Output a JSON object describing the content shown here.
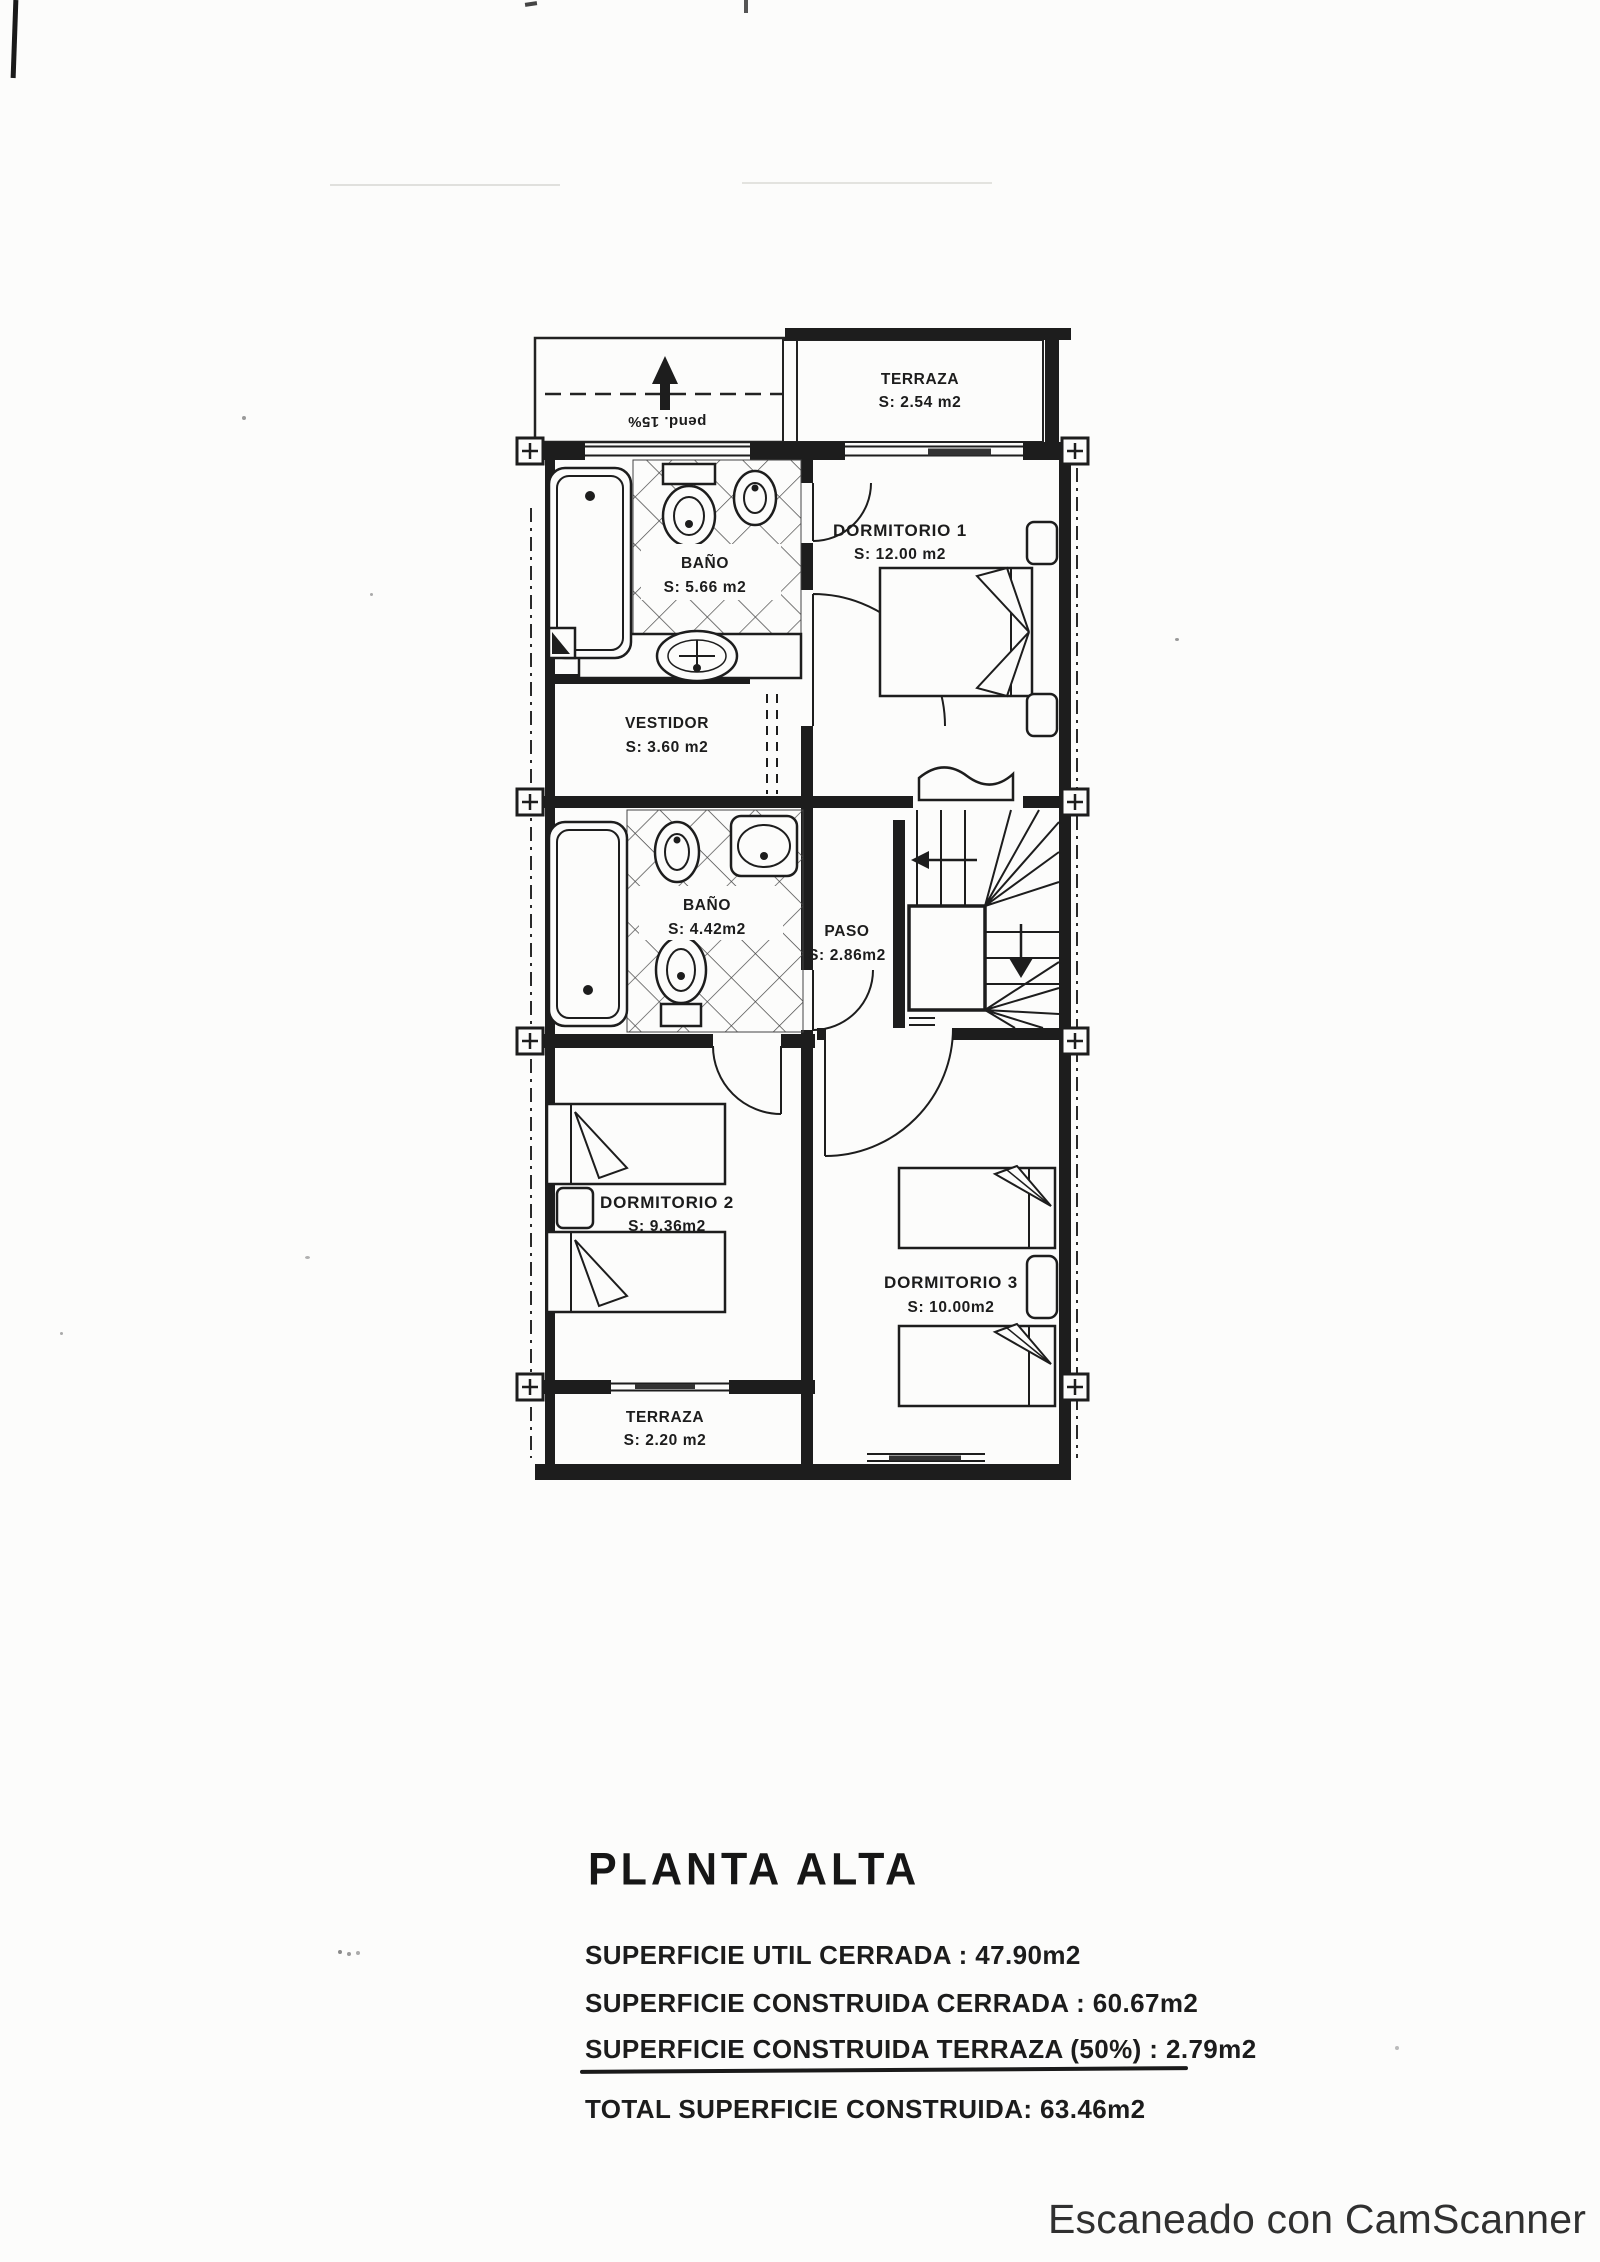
{
  "plan": {
    "slope_note": "pend. 15%",
    "rooms": {
      "terraza_top": {
        "label": "TERRAZA",
        "area": "S: 2.54 m2"
      },
      "dormitorio1": {
        "label": "DORMITORIO 1",
        "area": "S: 12.00 m2"
      },
      "bano1": {
        "label": "BAÑO",
        "area": "S: 5.66 m2"
      },
      "vestidor": {
        "label": "VESTIDOR",
        "area": "S: 3.60 m2"
      },
      "bano2": {
        "label": "BAÑO",
        "area": "S: 4.42m2"
      },
      "paso": {
        "label": "PASO",
        "area": "S: 2.86m2"
      },
      "dormitorio2": {
        "label": "DORMITORIO 2",
        "area": "S: 9.36m2"
      },
      "dormitorio3": {
        "label": "DORMITORIO 3",
        "area": "S: 10.00m2"
      },
      "terraza_bottom": {
        "label": "TERRAZA",
        "area": "S: 2.20 m2"
      }
    }
  },
  "summary": {
    "title": "PLANTA ALTA",
    "lines": [
      "SUPERFICIE UTIL CERRADA : 47.90m2",
      "SUPERFICIE CONSTRUIDA CERRADA : 60.67m2",
      "SUPERFICIE CONSTRUIDA TERRAZA (50%) : 2.79m2",
      "TOTAL SUPERFICIE CONSTRUIDA: 63.46m2"
    ]
  },
  "footer": {
    "watermark": "Escaneado con CamScanner"
  },
  "colors": {
    "ink": "#1d1d1d",
    "paper": "#fcfcfb"
  }
}
